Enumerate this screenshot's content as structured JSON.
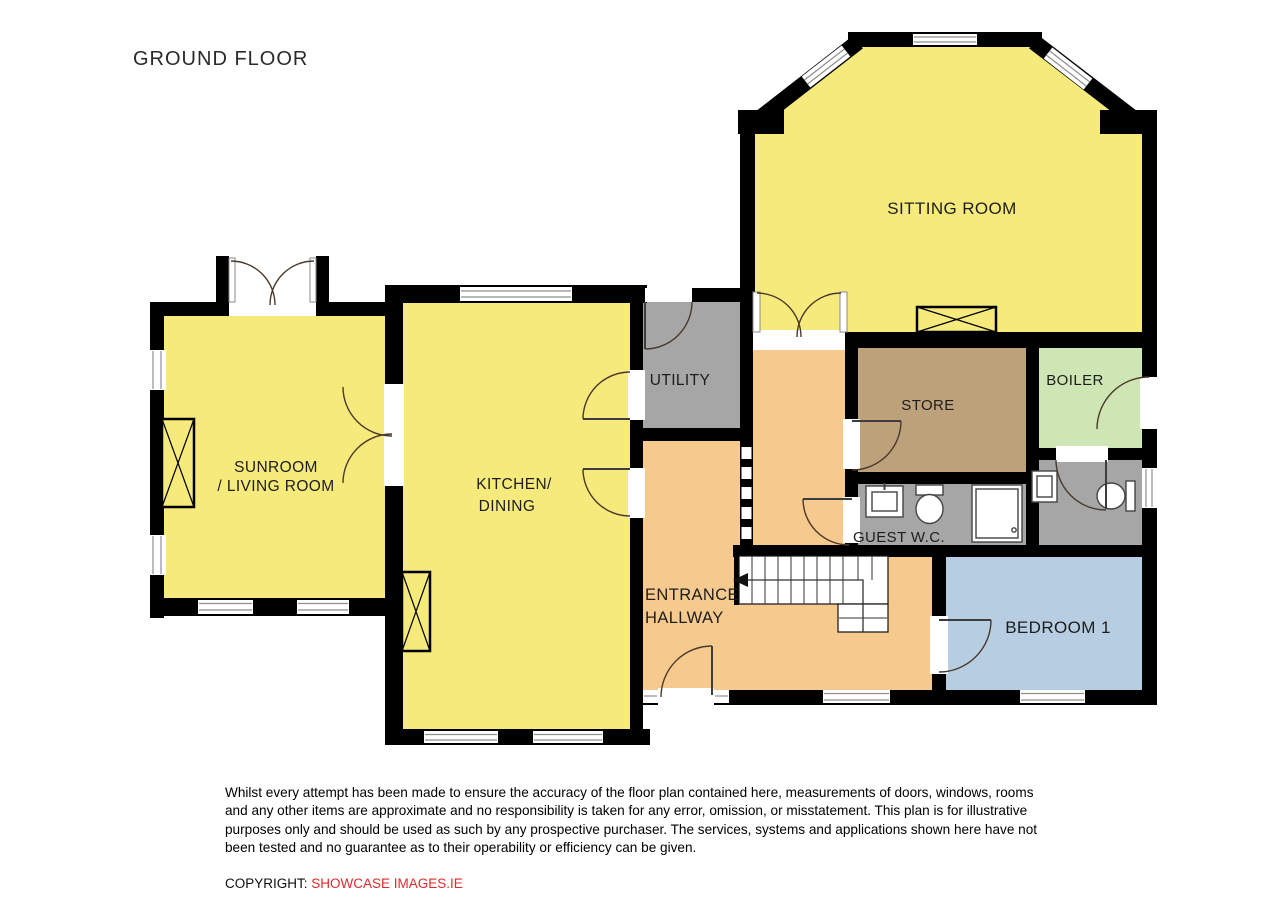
{
  "title": "GROUND FLOOR",
  "rooms": {
    "sitting_room": {
      "label": "SITTING ROOM",
      "color": "#f6ea7d"
    },
    "sunroom": {
      "label_line1": "SUNROOM",
      "label_line2": "/ LIVING ROOM",
      "color": "#f6ea7d"
    },
    "kitchen": {
      "label_line1": "KITCHEN/",
      "label_line2": "DINING",
      "color": "#f6ea7d"
    },
    "utility": {
      "label": "UTILITY",
      "color": "#a6a6a6"
    },
    "store": {
      "label": "STORE",
      "color": "#bda17b"
    },
    "boiler": {
      "label": "BOILER",
      "color": "#cee5b4"
    },
    "guest_wc": {
      "label": "GUEST W.C.",
      "color": "#a6a6a6"
    },
    "small_wc": {
      "color": "#a6a6a6"
    },
    "hallway": {
      "label_line1": "ENTRANCE",
      "label_line2": "HALLWAY",
      "color": "#f6ca8e"
    },
    "bedroom1": {
      "label": "BEDROOM 1",
      "color": "#b7cde1"
    }
  },
  "colors": {
    "wall": "#000000",
    "copyright_brand": "#e4292b",
    "floor_yellow": "#f6ea7d",
    "floor_orange": "#f6ca8e",
    "floor_gray": "#a6a6a6",
    "floor_tan": "#bda17b",
    "floor_green": "#cee5b4",
    "floor_blue": "#b7cde1"
  },
  "footer": {
    "disclaimer": "Whilst every attempt has been made to ensure the accuracy of the floor plan contained here, measurements of doors, windows, rooms and any other items are approximate and no responsibility is taken for any error, omission, or misstatement.  This plan is for illustrative purposes only and should be used as such by any prospective purchaser.  The services, systems and applications shown here have not been tested and no guarantee as to their operability or efficiency can be given.",
    "copyright_prefix": "COPYRIGHT: ",
    "copyright_brand": "SHOWCASE IMAGES.IE"
  }
}
